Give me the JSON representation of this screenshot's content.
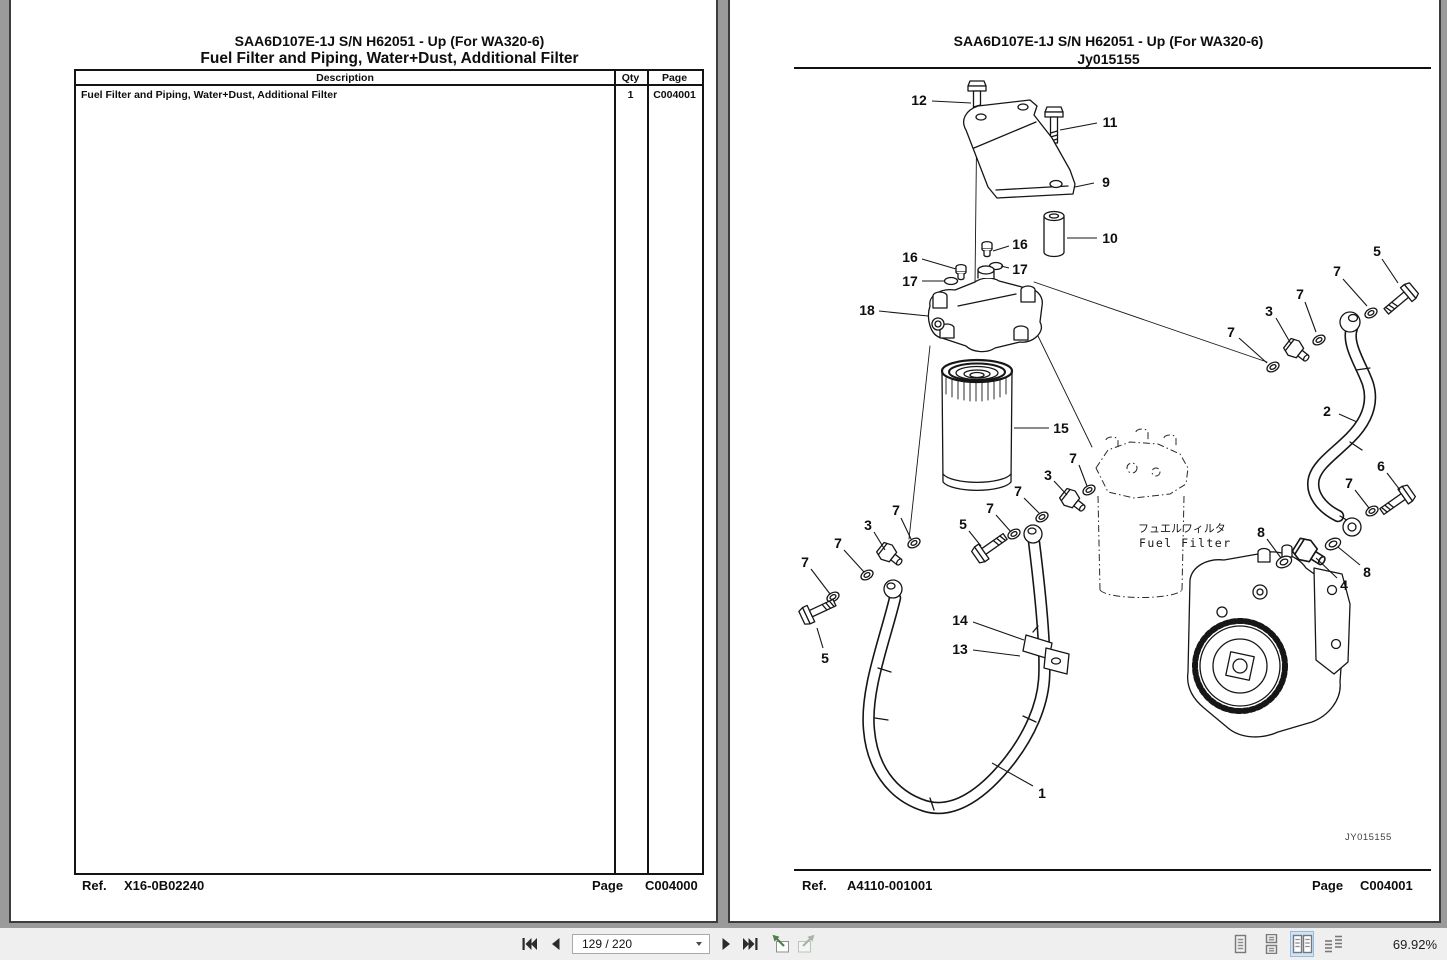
{
  "toolbar": {
    "page_indicator": "129 / 220",
    "zoom_level": "69.92%",
    "selected_view": "facing-view",
    "icons": [
      "first-page",
      "previous-page",
      "page-dropdown",
      "next-page",
      "last-page",
      "previous-view",
      "next-view",
      "single-page-view",
      "continuous-view",
      "facing-view",
      "continuous-facing-view"
    ],
    "colors": {
      "selected_view_bg": "#cfe4f6",
      "previous_view_arrow": "#4f7f4f",
      "icon_gray": "#787878"
    }
  },
  "left_page": {
    "header_line1": "SAA6D107E-1J S/N H62051 - Up (For WA320-6)",
    "header_line2": "Fuel Filter and Piping, Water+Dust, Additional Filter",
    "table": {
      "columns": [
        "Description",
        "Qty",
        "Page"
      ],
      "rows": [
        {
          "description": "Fuel Filter and Piping, Water+Dust, Additional Filter",
          "qty": "1",
          "page": "C004001"
        }
      ]
    },
    "footer": {
      "ref_label": "Ref.",
      "ref_value": "X16-0B02240",
      "page_label": "Page",
      "page_value": "C004000"
    }
  },
  "right_page": {
    "header_line1": "SAA6D107E-1J S/N H62051 - Up (For WA320-6)",
    "header_line2": "Jy015155",
    "figure_code": "JY015155",
    "filter_label_jp": "フュエルフィルタ",
    "filter_label_en": "Fuel Filter",
    "footer": {
      "ref_label": "Ref.",
      "ref_value": "A4110-001001",
      "page_label": "Page",
      "page_value": "C004001"
    },
    "callouts": [
      {
        "label": "12",
        "tx": 129,
        "ty": 30,
        "x1": 142,
        "y1": 31,
        "x2": 181,
        "y2": 33
      },
      {
        "label": "11",
        "tx": 320,
        "ty": 52,
        "x1": 307,
        "y1": 53,
        "x2": 270,
        "y2": 60
      },
      {
        "label": "9",
        "tx": 316,
        "ty": 112,
        "x1": 304,
        "y1": 113,
        "x2": 285,
        "y2": 117
      },
      {
        "label": "10",
        "tx": 320,
        "ty": 168,
        "x1": 307,
        "y1": 168,
        "x2": 277,
        "y2": 168
      },
      {
        "label": "16",
        "tx": 230,
        "ty": 174,
        "x1": 219,
        "y1": 176,
        "x2": 203,
        "y2": 181
      },
      {
        "label": "17",
        "tx": 230,
        "ty": 199,
        "x1": 219,
        "y1": 198,
        "x2": 211,
        "y2": 196
      },
      {
        "label": "16",
        "tx": 120,
        "ty": 187,
        "x1": 132,
        "y1": 189,
        "x2": 166,
        "y2": 199
      },
      {
        "label": "17",
        "tx": 120,
        "ty": 211,
        "x1": 132,
        "y1": 211,
        "x2": 154,
        "y2": 211
      },
      {
        "label": "18",
        "tx": 77,
        "ty": 240,
        "x1": 89,
        "y1": 241,
        "x2": 138,
        "y2": 246
      },
      {
        "label": "15",
        "tx": 271,
        "ty": 358,
        "x1": 259,
        "y1": 358,
        "x2": 224,
        "y2": 358
      },
      {
        "label": "5",
        "tx": 587,
        "ty": 181,
        "x1": 592,
        "y1": 189,
        "x2": 608,
        "y2": 213
      },
      {
        "label": "7",
        "tx": 547,
        "ty": 201,
        "x1": 553,
        "y1": 209,
        "x2": 577,
        "y2": 236
      },
      {
        "label": "7",
        "tx": 510,
        "ty": 224,
        "x1": 515,
        "y1": 232,
        "x2": 526,
        "y2": 262
      },
      {
        "label": "3",
        "tx": 479,
        "ty": 241,
        "x1": 486,
        "y1": 248,
        "x2": 501,
        "y2": 274
      },
      {
        "label": "7",
        "tx": 441,
        "ty": 262,
        "x1": 449,
        "y1": 268,
        "x2": 477,
        "y2": 293
      },
      {
        "label": "2",
        "tx": 537,
        "ty": 341,
        "x1": 549,
        "y1": 344,
        "x2": 567,
        "y2": 352
      },
      {
        "label": "6",
        "tx": 591,
        "ty": 396,
        "x1": 597,
        "y1": 403,
        "x2": 610,
        "y2": 420
      },
      {
        "label": "7",
        "tx": 559,
        "ty": 413,
        "x1": 565,
        "y1": 420,
        "x2": 579,
        "y2": 438
      },
      {
        "label": "7",
        "tx": 283,
        "ty": 388,
        "x1": 289,
        "y1": 395,
        "x2": 297,
        "y2": 416
      },
      {
        "label": "3",
        "tx": 258,
        "ty": 405,
        "x1": 264,
        "y1": 411,
        "x2": 277,
        "y2": 425
      },
      {
        "label": "7",
        "tx": 228,
        "ty": 421,
        "x1": 234,
        "y1": 428,
        "x2": 249,
        "y2": 443
      },
      {
        "label": "7",
        "tx": 200,
        "ty": 438,
        "x1": 206,
        "y1": 445,
        "x2": 221,
        "y2": 462
      },
      {
        "label": "5",
        "tx": 173,
        "ty": 454,
        "x1": 179,
        "y1": 461,
        "x2": 191,
        "y2": 476
      },
      {
        "label": "7",
        "tx": 106,
        "ty": 440,
        "x1": 111,
        "y1": 448,
        "x2": 121,
        "y2": 469
      },
      {
        "label": "3",
        "tx": 78,
        "ty": 455,
        "x1": 84,
        "y1": 462,
        "x2": 95,
        "y2": 480
      },
      {
        "label": "7",
        "tx": 48,
        "ty": 473,
        "x1": 54,
        "y1": 480,
        "x2": 74,
        "y2": 502
      },
      {
        "label": "7",
        "tx": 15,
        "ty": 492,
        "x1": 21,
        "y1": 499,
        "x2": 40,
        "y2": 524
      },
      {
        "label": "5",
        "tx": 35,
        "ty": 588,
        "x1": 33,
        "y1": 578,
        "x2": 27,
        "y2": 558
      },
      {
        "label": "14",
        "tx": 170,
        "ty": 550,
        "x1": 183,
        "y1": 552,
        "x2": 234,
        "y2": 570
      },
      {
        "label": "13",
        "tx": 170,
        "ty": 579,
        "x1": 183,
        "y1": 580,
        "x2": 230,
        "y2": 586
      },
      {
        "label": "1",
        "tx": 252,
        "ty": 723,
        "x1": 243,
        "y1": 716,
        "x2": 202,
        "y2": 693
      },
      {
        "label": "8",
        "tx": 471,
        "ty": 462,
        "x1": 477,
        "y1": 469,
        "x2": 491,
        "y2": 488
      },
      {
        "label": "4",
        "tx": 554,
        "ty": 515,
        "x1": 547,
        "y1": 508,
        "x2": 526,
        "y2": 488
      },
      {
        "label": "8",
        "tx": 577,
        "ty": 502,
        "x1": 570,
        "y1": 495,
        "x2": 548,
        "y2": 477
      }
    ]
  }
}
